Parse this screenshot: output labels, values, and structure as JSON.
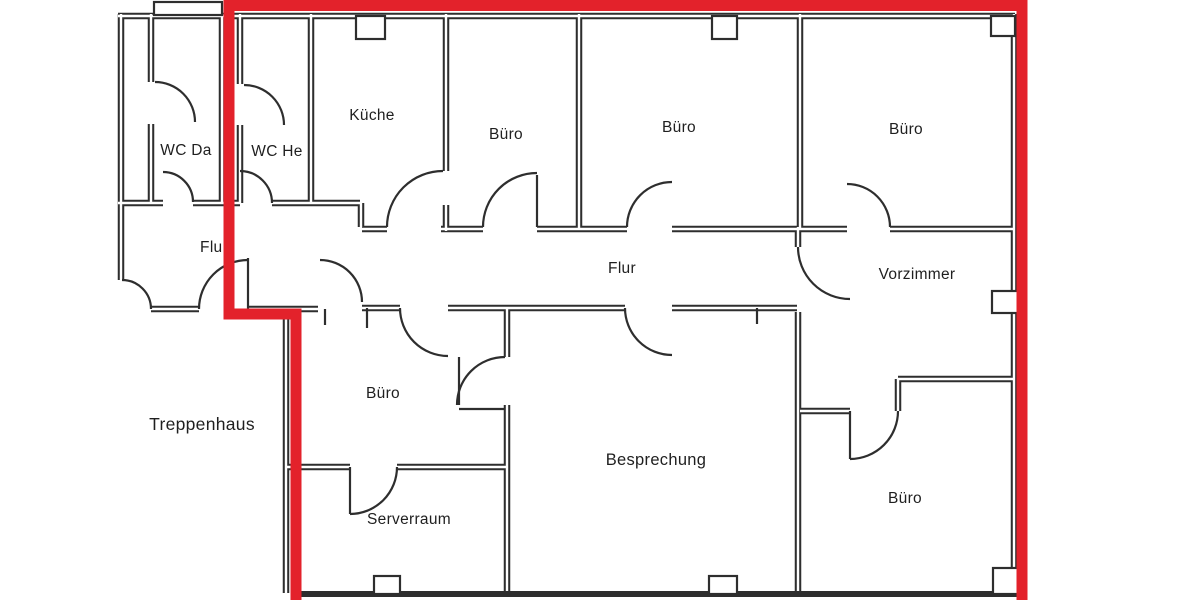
{
  "document": {
    "type": "scanned-floor-plan",
    "language": "de"
  },
  "colors": {
    "highlight": "#e3222b",
    "walls": "#2e2e2e",
    "background": "#ffffff",
    "text": "#1f1f1f"
  },
  "rooms": {
    "wc_da": {
      "label": "WC Da"
    },
    "wc_he": {
      "label": "WC He"
    },
    "kueche": {
      "label": "Küche"
    },
    "buero_top_left": {
      "label": "Büro"
    },
    "buero_top_middle": {
      "label": "Büro"
    },
    "buero_top_right": {
      "label": "Büro"
    },
    "flur_left": {
      "label": "Flur"
    },
    "flur_main": {
      "label": "Flur"
    },
    "vorzimmer": {
      "label": "Vorzimmer"
    },
    "buero_middle_left": {
      "label": "Büro"
    },
    "treppenhaus": {
      "label": "Treppenhaus"
    },
    "besprechung": {
      "label": "Besprechung"
    },
    "serverraum": {
      "label": "Serverraum"
    },
    "buero_bottom_right": {
      "label": "Büro"
    }
  }
}
